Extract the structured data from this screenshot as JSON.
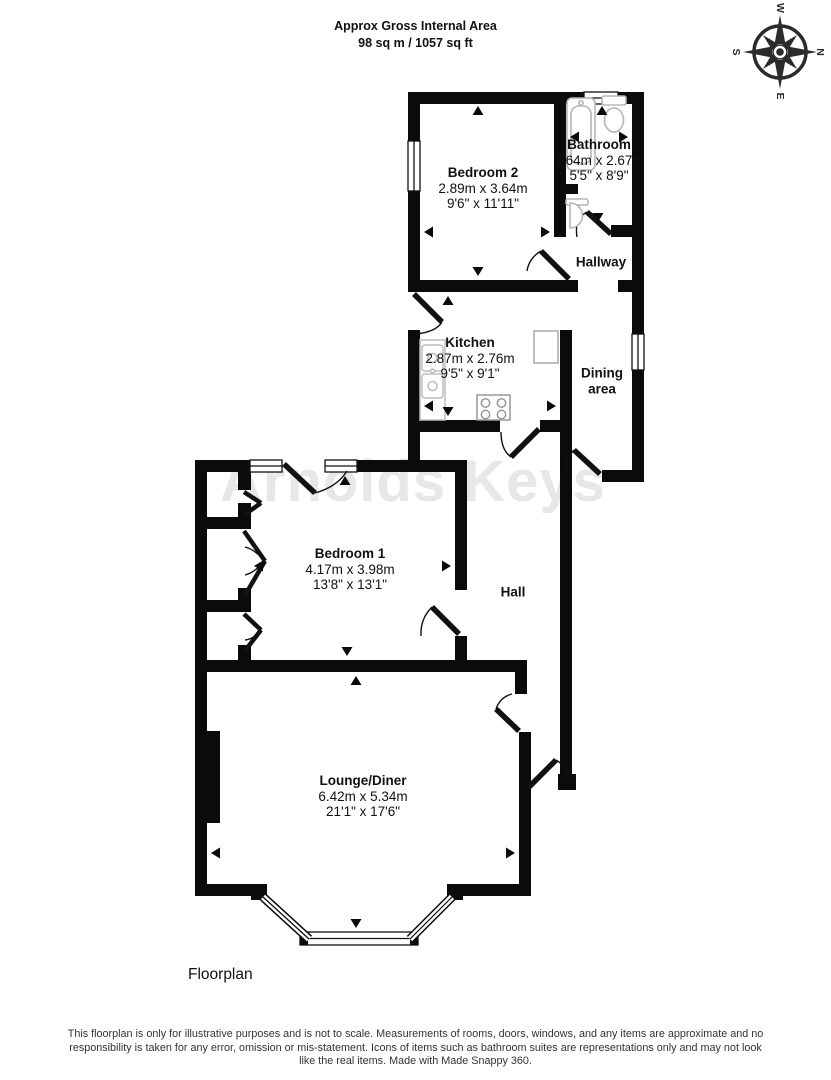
{
  "header": {
    "title": "Approx Gross Internal Area",
    "subtitle": "98 sq m / 1057 sq ft"
  },
  "compass": {
    "n": "N",
    "e": "E",
    "s": "S",
    "w": "W"
  },
  "watermark": "Arnolds Keys",
  "rooms": [
    {
      "id": "bedroom2",
      "name": "Bedroom 2",
      "metric": "2.89m x 3.64m",
      "imperial": "9'6\" x 11'11\""
    },
    {
      "id": "bathroom",
      "name": "Bathroom",
      "metric": "1.64m x 2.67m",
      "imperial": "5'5\" x 8'9\""
    },
    {
      "id": "hallway",
      "name": "Hallway"
    },
    {
      "id": "kitchen",
      "name": "Kitchen",
      "metric": "2.87m x 2.76m",
      "imperial": "9'5\" x 9'1\""
    },
    {
      "id": "dining",
      "name": "Dining area"
    },
    {
      "id": "bedroom1",
      "name": "Bedroom 1",
      "metric": "4.17m x 3.98m",
      "imperial": "13'8\" x 13'1\""
    },
    {
      "id": "hall",
      "name": "Hall"
    },
    {
      "id": "lounge",
      "name": "Lounge/Diner",
      "metric": "6.42m x 5.34m",
      "imperial": "21'1\" x 17'6\""
    }
  ],
  "caption": "Floorplan",
  "footer": {
    "disclaimer": "This floorplan is only for illustrative purposes and is not to scale. Measurements of rooms, doors, windows, and any items are approximate and no responsibility is taken for any error, omission or mis-statement. Icons of items such as bathroom suites are representations only and may not look like the real items. Made with Made Snappy 360."
  }
}
